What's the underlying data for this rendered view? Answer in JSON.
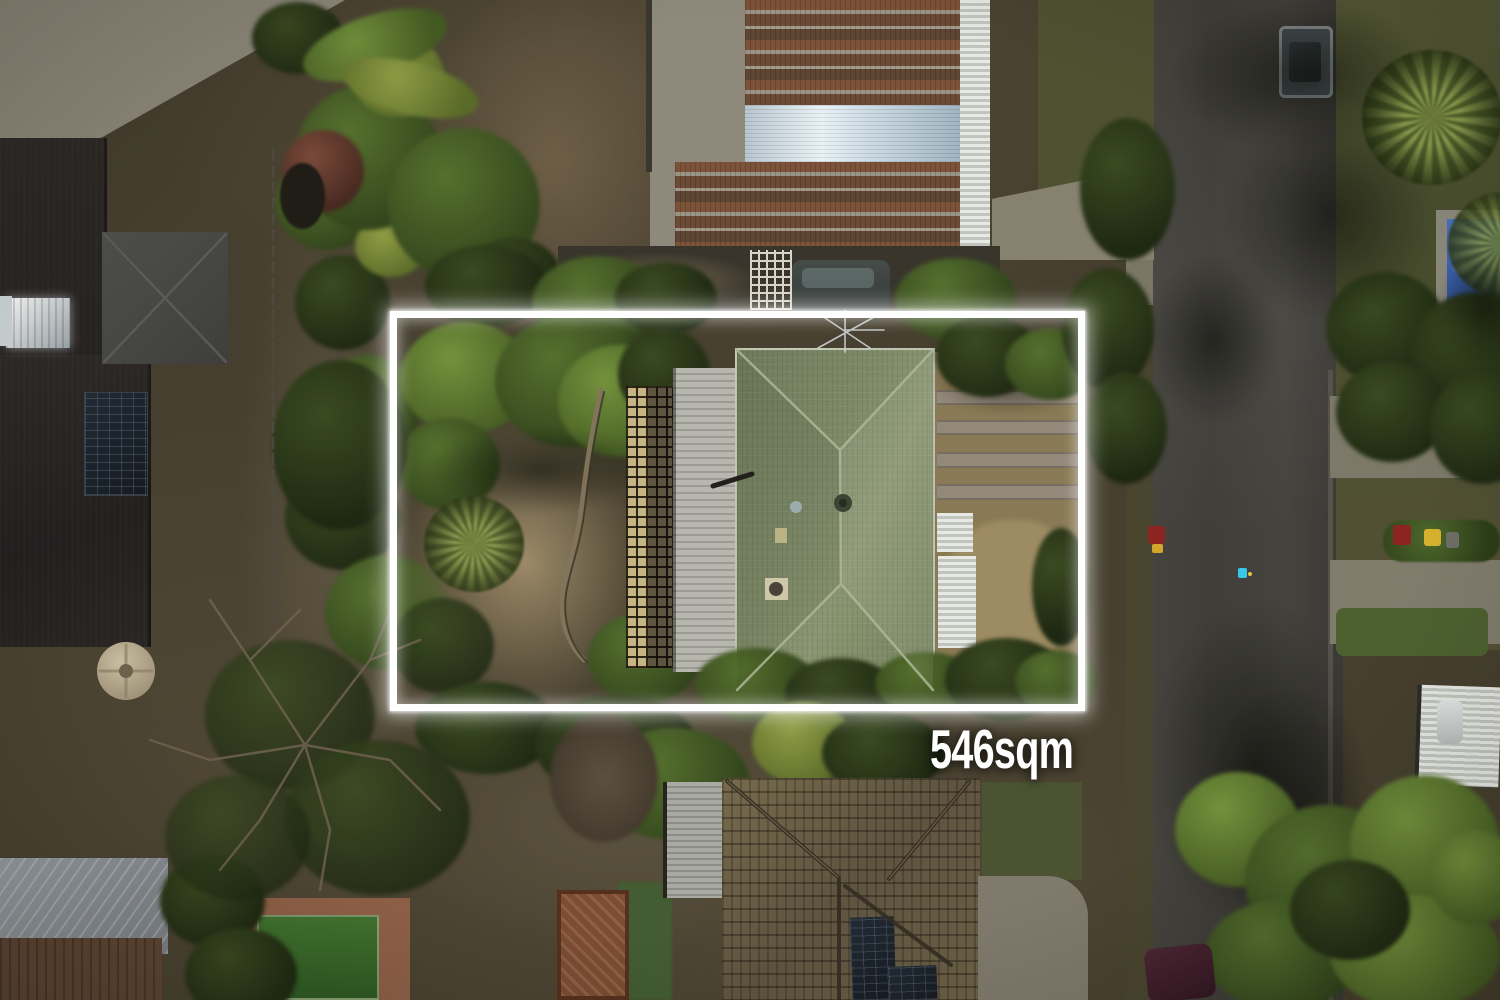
{
  "annotation": {
    "area_label": "546sqm",
    "label_color": "#ffffff",
    "boundary_color": "#ffffff",
    "boundary_style": "glowing solid rectangle outline"
  },
  "scene": {
    "type": "aerial-drone-photo-of-residential-lot",
    "key_colors": {
      "road_asphalt": "#403e39",
      "subject_roof_green": "#7d8a68",
      "neighbor_roof_rust": "#7c5238",
      "neighbor_roof_silver": "#cfdde6",
      "bottom_roof_shingle": "#6c6147",
      "left_roof_dark": "#2a2623",
      "pool_tarp_blue": "#3a62b2",
      "vegetation_dark": "#2c3a1c",
      "vegetation_bright": "#5d7a33",
      "dry_grass": "#8c7c57",
      "deck_grey": "#aeaea7",
      "lattice_tan": "#c6b485"
    }
  }
}
